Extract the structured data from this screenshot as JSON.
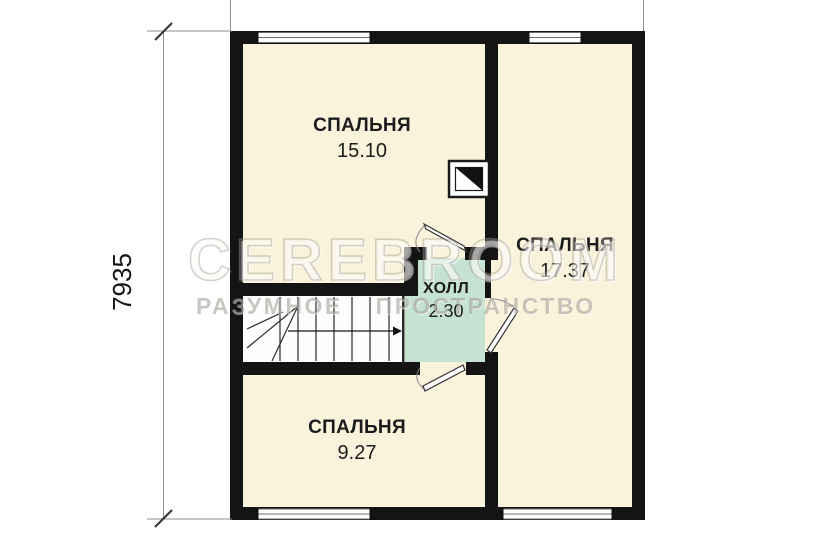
{
  "plan": {
    "watermark": {
      "line1": "CEREBROOM",
      "line2": "РАЗУМНОЕ ПРОСТРАНСТВО"
    },
    "dimensions": {
      "height": "7935"
    },
    "rooms": [
      {
        "id": "bedroom-top-left",
        "name": "СПАЛЬНЯ",
        "area": "15.10"
      },
      {
        "id": "bedroom-right",
        "name": "СПАЛЬНЯ",
        "area": "17.37"
      },
      {
        "id": "hall",
        "name": "ХОЛЛ",
        "area": "2.30"
      },
      {
        "id": "bedroom-bottom-left",
        "name": "СПАЛЬНЯ",
        "area": "9.27"
      }
    ],
    "colors": {
      "wall": "#141414",
      "room_fill": "#faf3dc",
      "hall_fill": "#c5e2d3",
      "stair_fill": "#fdfdfd",
      "dimension_line": "#8f8f8f"
    }
  }
}
